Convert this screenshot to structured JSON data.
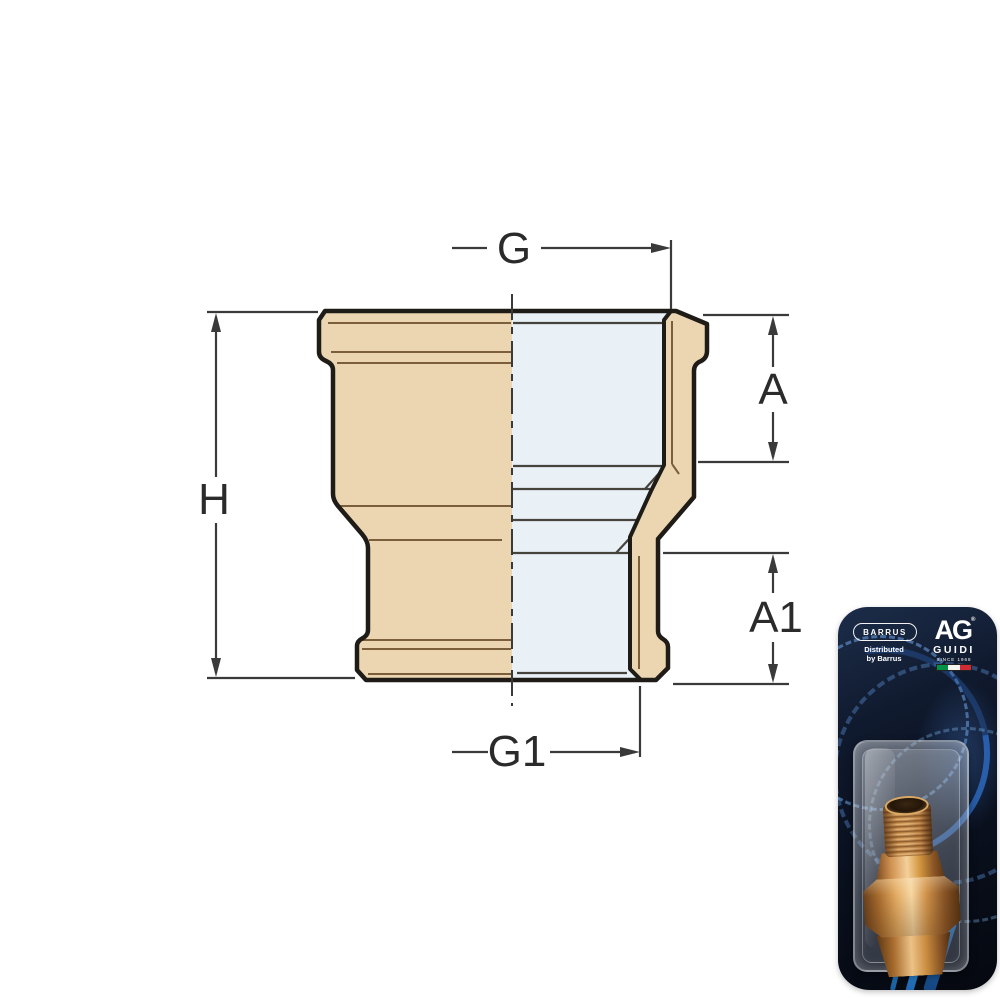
{
  "diagram": {
    "title": "reducing-socket-dimension-drawing",
    "dimension_labels": {
      "g": "G",
      "h": "H",
      "a": "A",
      "a1": "A1",
      "g1": "G1"
    },
    "colors": {
      "body_tan": "#ecd6b2",
      "section_blue": "#e9f1f7",
      "outline": "#1f1c18",
      "dimension_line": "#3a3a3a",
      "detail_brown": "#7a5f3a"
    }
  },
  "packaging": {
    "brand_badge": "BARRUS",
    "distributor_line1": "Distributed",
    "distributor_line2": "by Barrus",
    "logo": {
      "monogram": "AG",
      "registered_mark": "®",
      "name": "GUIDI",
      "tagline": "SINCE 1968"
    },
    "flag_colors": [
      "#009246",
      "#f4f5f0",
      "#ce2b37"
    ]
  }
}
